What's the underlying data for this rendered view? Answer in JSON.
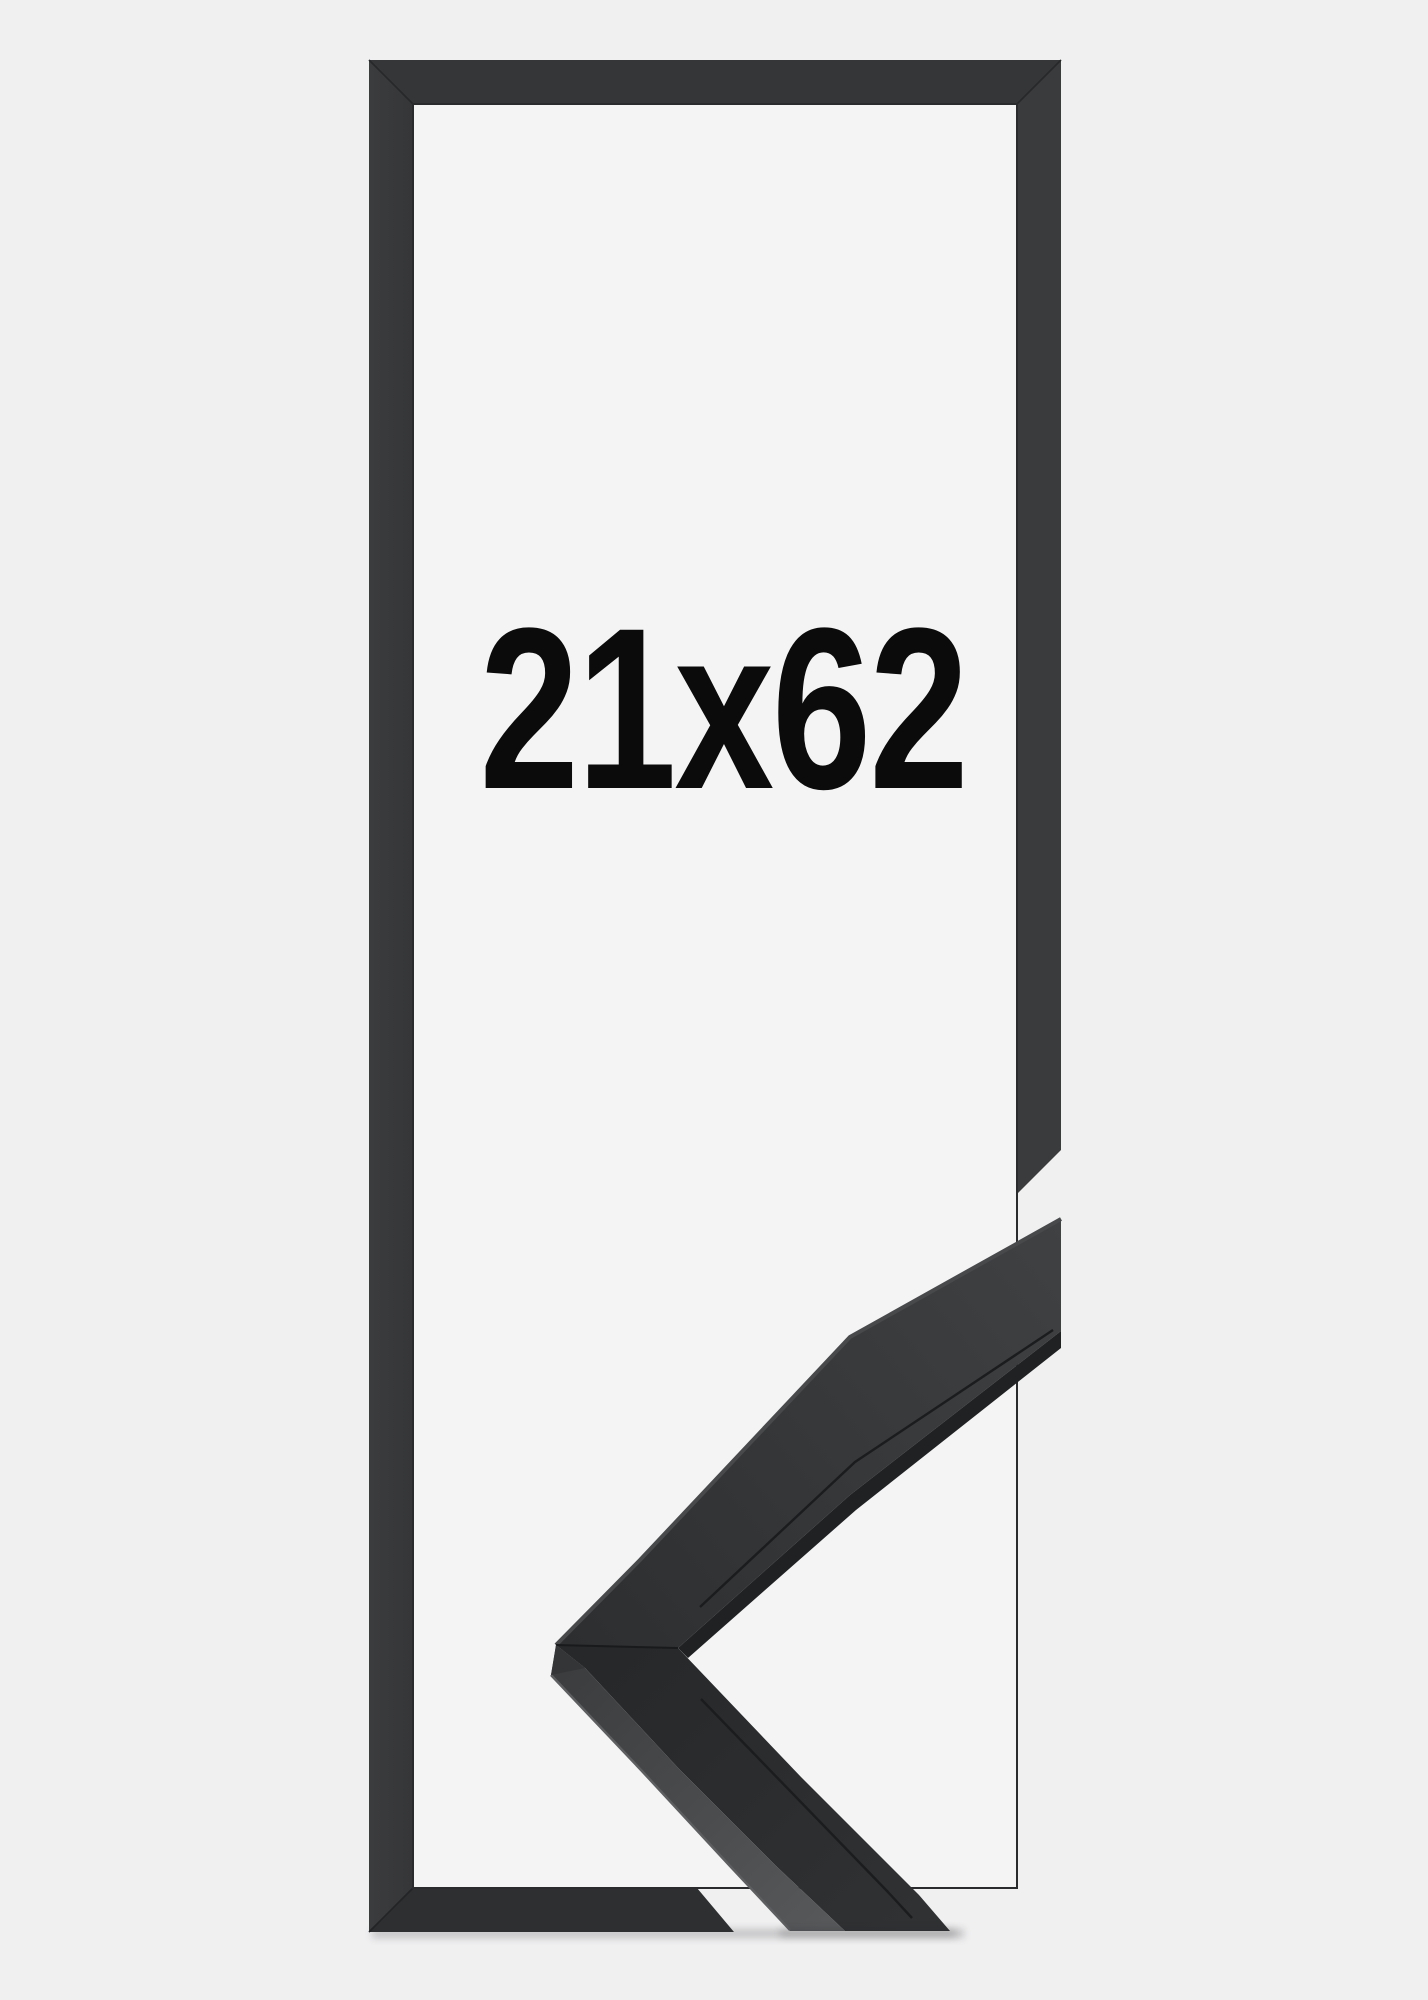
{
  "product_photo": {
    "size_label": "21x62",
    "colors": {
      "background": "#f0f0f1",
      "frame_interior": "#f4f4f5",
      "frame_top_bar": "#343638",
      "frame_left_bar": "#38393b",
      "frame_right_bar": "#3a3b3d",
      "frame_bottom_bar": "#2d2f31",
      "sample_top_face_dark": "#2c2e30",
      "sample_top_face_light": "#3f4143",
      "sample_side_face": "#56585a",
      "sample_edge_shadow": "#1f2123",
      "label_text": "#0b0b0c"
    }
  }
}
